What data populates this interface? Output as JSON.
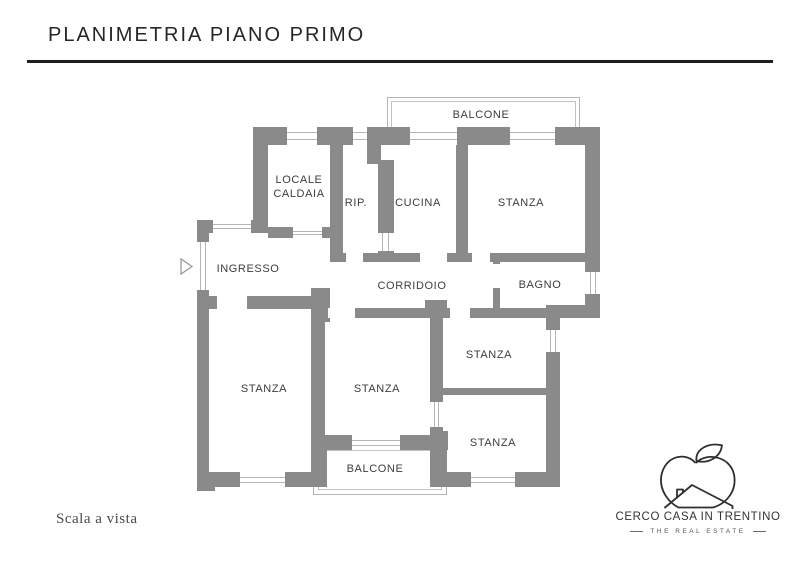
{
  "header": {
    "title": "PLANIMETRIA PIANO PRIMO"
  },
  "plan": {
    "labels": {
      "balcone_top": "BALCONE",
      "locale_caldaia_line1": "LOCALE",
      "locale_caldaia_line2": "CALDAIA",
      "rip": "RIP.",
      "cucina": "CUCINA",
      "stanza_ne": "STANZA",
      "ingresso": "INGRESSO",
      "corridoio": "CORRIDOIO",
      "bagno": "BAGNO",
      "stanza_w": "STANZA",
      "stanza_c": "STANZA",
      "stanza_e1": "STANZA",
      "stanza_e2": "STANZA",
      "balcone_bottom": "BALCONE"
    },
    "colors": {
      "wall": "#8a8a8a",
      "frame_line": "#b5b5b5"
    }
  },
  "footer": {
    "scale_note": "Scala a vista"
  },
  "logo": {
    "name": "CERCO CASA IN TRENTINO",
    "tagline": "THE REAL ESTATE"
  }
}
